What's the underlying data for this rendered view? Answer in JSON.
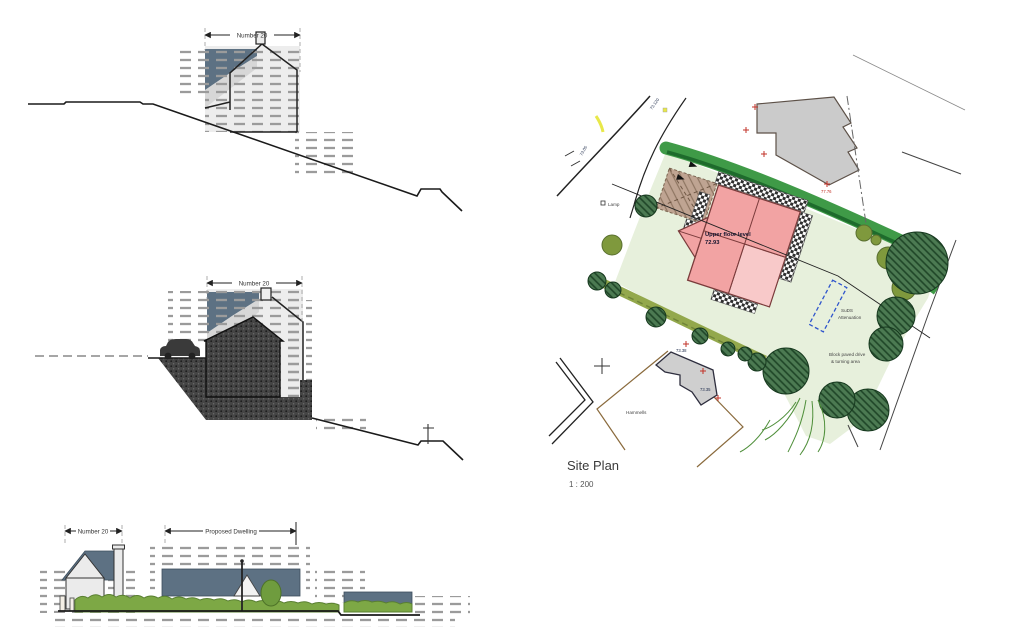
{
  "drawings": {
    "section_upper": {
      "dim_label": "Number 20"
    },
    "section_lower": {
      "dim_label": "Number 20"
    },
    "street_elevation": {
      "dim_left": "Number 20",
      "dim_right": "Proposed Dwelling"
    }
  },
  "site_plan": {
    "title": "Site Plan",
    "scale": "1 : 200",
    "upper_floor_label": "Upper floor level",
    "upper_floor_level": "72.93",
    "suds_label_1": "SuDS",
    "suds_label_2": "Attenuation",
    "drive_label_1": "Block paved drive",
    "drive_label_2": "& turning area",
    "parcel_name": "Hammells",
    "road_levels": [
      "73.120",
      "73.05"
    ],
    "lamp_label": "Lamp",
    "survey_levels": [
      "73.38",
      "73.35"
    ],
    "marker_level": "77.76",
    "colors": {
      "lawn": "#e7f0dc",
      "hedge_dark": "#3f9a47",
      "hedge_olive": "#93a84c",
      "tree": "#4c7a52",
      "shrub_olive": "#7f993d",
      "building_pink": "#f2a3a3",
      "building_pink_light": "#f8c9c9",
      "garage_tan": "#bfa492",
      "neighbor_gray": "#cbcbcb",
      "roof_blue": "#5d7183",
      "elevation_hedge": "#7da845",
      "suds_blue": "#2f55cc",
      "marker_red": "#c23227",
      "road_highlight": "#e8e84a"
    }
  }
}
